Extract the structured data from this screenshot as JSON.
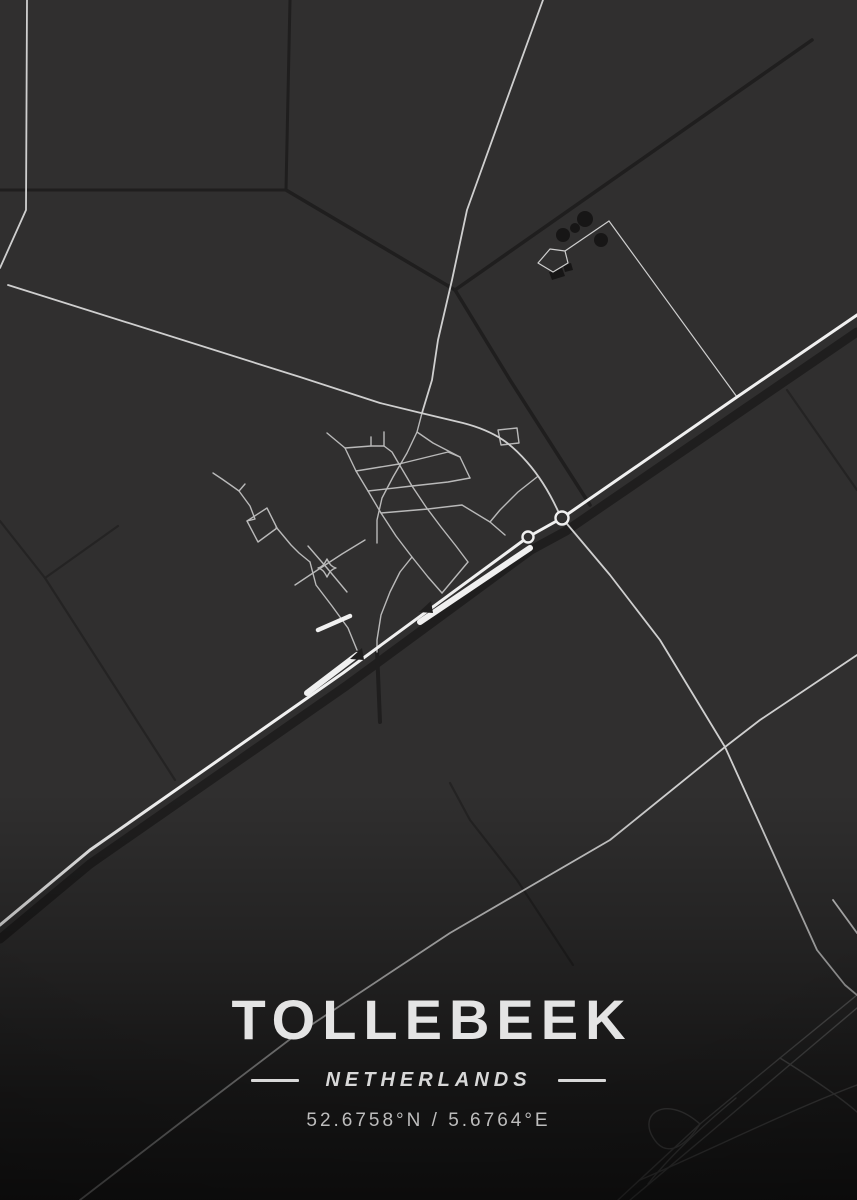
{
  "poster": {
    "title": "TOLLEBEEK",
    "subtitle": "NETHERLANDS",
    "coordinates": "52.6758°N / 5.6764°E"
  },
  "theme": {
    "background": "#302f2f",
    "title_color": "#e4e4e4",
    "subtitle_color": "#d8d8d8",
    "coords_color": "#bdbdbd",
    "highway_color": "#f0f0f0",
    "road_color": "#cfcfcf",
    "street_color": "#b9b9b9",
    "canal_color": "#1f1e1e",
    "field_line_color": "#242323",
    "building_color": "#171616"
  },
  "map": {
    "viewbox": "0 0 857 1200",
    "layers": [
      {
        "name": "field-lines",
        "stroke": "#242323",
        "width": 2.2,
        "fill": "none",
        "paths": [
          {
            "d": "M0,521 L45,578 L175,780"
          },
          {
            "d": "M45,578 L118,526"
          },
          {
            "d": "M787,390 L857,490"
          },
          {
            "d": "M450,783 L470,820 L517,880 L573,965"
          }
        ]
      },
      {
        "name": "canals",
        "stroke": "#1f1e1e",
        "width": 3.5,
        "fill": "none",
        "paths": [
          {
            "d": "M857,332 L740,412 L566,531 L531,550 L346,686 L90,864 L0,939",
            "width": 9
          },
          {
            "d": "M290,0 L286,190",
            "width": 3
          },
          {
            "d": "M0,190 L286,190",
            "width": 3
          },
          {
            "d": "M286,190 L455,290"
          },
          {
            "d": "M812,40 L455,290"
          },
          {
            "d": "M455,290 L510,380 L590,505"
          },
          {
            "d": "M377,650 L380,722",
            "width": 4
          }
        ]
      },
      {
        "name": "farm-buildings",
        "stroke": "none",
        "width": 0,
        "fill": "#171616",
        "paths": [
          {
            "d": "M549,272 l13,-4 l3,8 l-13,4 Z"
          },
          {
            "d": "M563,265 l8,-2 l2,7 l-8,2 Z"
          }
        ],
        "circles": [
          {
            "cx": 563,
            "cy": 235,
            "r": 7
          },
          {
            "cx": 585,
            "cy": 219,
            "r": 8
          },
          {
            "cx": 601,
            "cy": 240,
            "r": 7
          },
          {
            "cx": 575,
            "cy": 228,
            "r": 5
          }
        ]
      },
      {
        "name": "interchange-ramps",
        "stroke": "#9e9e9e",
        "width": 1.4,
        "fill": "none",
        "opacity": 0.55,
        "paths": [
          {
            "d": "M857,995 L780,1058 L700,1124 L618,1200"
          },
          {
            "d": "M857,1008 L786,1068 L706,1136 L630,1200"
          },
          {
            "d": "M700,1124 C664,1092 634,1116 657,1143 C671,1158 689,1141 700,1124"
          },
          {
            "d": "M780,1058 C815,1080 841,1098 857,1112"
          },
          {
            "d": "M736,1098 C700,1128 670,1156 648,1184"
          },
          {
            "d": "M640,1180 C706,1152 790,1110 857,1085"
          }
        ]
      },
      {
        "name": "village-streets",
        "stroke": "#b9b9b9",
        "width": 1.4,
        "fill": "none",
        "paths": [
          {
            "d": "M422,413 L417,432 L407,453 L393,477 L382,498 L377,520 L377,543"
          },
          {
            "d": "M327,433 L345,448 L356,471 L368,491 L381,513 L396,536 L412,557 L428,577 L442,593"
          },
          {
            "d": "M417,432 L433,443 L460,457 L470,478"
          },
          {
            "d": "M345,448 L371,446 L384,446 L392,452 L399,464"
          },
          {
            "d": "M371,437 L371,446"
          },
          {
            "d": "M384,432 L384,446"
          },
          {
            "d": "M399,464 L412,486 L426,507 L441,527 L456,546 L468,562"
          },
          {
            "d": "M356,471 L399,464 L448,452 L460,457"
          },
          {
            "d": "M368,491 L412,486 L448,482 L470,478"
          },
          {
            "d": "M381,513 L428,509 L462,505 L490,522 L505,535"
          },
          {
            "d": "M276,527 L291,545 L299,553 L310,562"
          },
          {
            "d": "M295,585 L316,571 L342,554 L365,540"
          },
          {
            "d": "M308,546 L327,568 L347,592"
          },
          {
            "d": "M310,562 L316,585 L332,606 L348,628 L357,650"
          },
          {
            "d": "M412,557 L400,572 L390,592 L381,615 L377,640 L377,652"
          },
          {
            "d": "M442,593 L468,562"
          },
          {
            "d": "M537,477 L518,492 L500,510 L490,522"
          },
          {
            "d": "M498,430 L517,428 L519,443 L501,445 Z"
          },
          {
            "d": "M247,521 L267,508 L277,528 L258,542 Z"
          },
          {
            "d": "M213,473 L222,479 L232,486 L239,491 L250,506 L255,519 L247,521"
          },
          {
            "d": "M239,491 L245,484"
          },
          {
            "d": "M327,559 C330,565 332,567 336,568 C332,569 330,571 327,577 C324,571 322,569 318,568 C322,567 324,565 327,559 Z"
          }
        ]
      },
      {
        "name": "rural-roads",
        "stroke": "#cfcfcf",
        "width": 1.8,
        "fill": "none",
        "paths": [
          {
            "d": "M27,0 L26,210 L0,268"
          },
          {
            "d": "M8,285 L300,377 L380,403 L421,413 L463,423 C498,432 513,446 527,462 C542,479 552,498 558,511 L562,518"
          },
          {
            "d": "M543,0 L503,110 L467,210 L452,280 L438,340 L432,380 L422,413"
          },
          {
            "d": "M562,518 L610,575 L660,640 L725,747 L817,950 L845,985 L857,995"
          },
          {
            "d": "M857,655 L760,720 L725,747 L610,840 L450,933 L293,1037 L180,1123 L80,1200"
          },
          {
            "d": "M833,900 L857,933"
          },
          {
            "d": "M538,263 L550,249 L565,251 L568,263 L553,272 Z",
            "width": 1.2
          },
          {
            "d": "M565,251 L609,221",
            "width": 1.2
          },
          {
            "d": "M609,221 L737,397",
            "width": 1.2
          }
        ]
      },
      {
        "name": "highway",
        "stroke": "#f0f0f0",
        "width": 3,
        "fill": "none",
        "paths": [
          {
            "d": "M857,315 L737,397 L562,518 L528,537 L343,673 L90,850 L0,925"
          },
          {
            "d": "M420,622 L530,548",
            "width": 6
          },
          {
            "d": "M307,693 L357,655",
            "width": 6
          },
          {
            "d": "M318,630 L350,616",
            "width": 4.5
          }
        ]
      },
      {
        "name": "bridge-markers",
        "stroke": "none",
        "width": 0,
        "fill": "#1f1e1e",
        "paths": [
          {
            "d": "M419,612 L431,601 L433,613 Z"
          },
          {
            "d": "M350,659 L362,648 L364,660 Z"
          }
        ]
      },
      {
        "name": "roundabouts",
        "stroke": "#f0f0f0",
        "width": 2.4,
        "fill": "#302f2f",
        "circles": [
          {
            "cx": 562,
            "cy": 518,
            "r": 6.5
          },
          {
            "cx": 528,
            "cy": 537,
            "r": 5.5
          }
        ]
      }
    ]
  }
}
